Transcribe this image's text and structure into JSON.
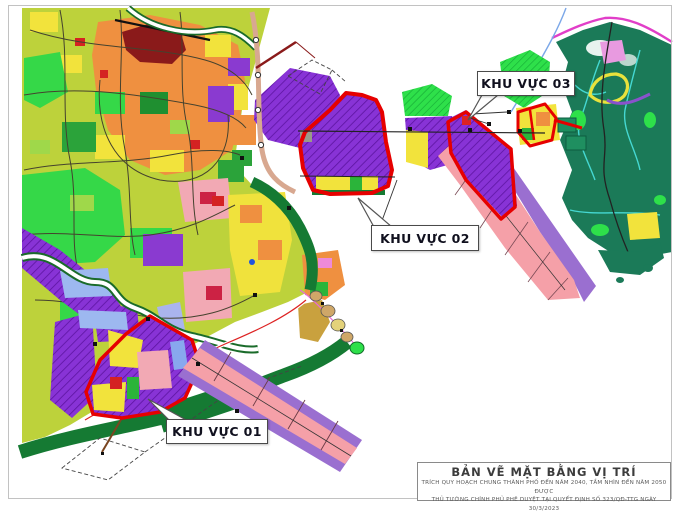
{
  "map": {
    "name": "urban-master-plan-location-map",
    "areas": [
      {
        "id": "01",
        "label": "KHU VỰC 01"
      },
      {
        "id": "02",
        "label": "KHU VỰC 02"
      },
      {
        "id": "03",
        "label": "KHU VỰC 03"
      }
    ],
    "title_block": {
      "title": "BẢN VẼ MẶT BẰNG VỊ TRÍ",
      "line1": "TRÍCH QUY HOẠCH CHUNG THÀNH PHỐ ĐẾN NĂM 2040, TẦM NHÌN ĐẾN NĂM 2050 ĐƯỢC",
      "line2": "THỦ TƯỚNG CHÍNH PHỦ PHÊ DUYỆT TẠI QUYẾT ĐỊNH SỐ 323/QĐ-TTG NGÀY 30/3/2023"
    },
    "colors": {
      "area_outline_red": "#e60000",
      "planned_zone_purple": "#8833d6",
      "corridor_pink": "#f5a0a8",
      "corridor_edge_purple": "#9a6fd0",
      "urban_base_yellow_green": "#bdd23b",
      "urban_orange": "#ef9040",
      "historic_dark_red": "#8a1a1a",
      "park_bright_green": "#35d848",
      "forest_dark_teal": "#1b7a58",
      "coast_band_green": "#157a33",
      "boundary_magenta": "#e13ec8",
      "stream_cyan": "#45d8d2",
      "residential_pink": "#f2a9b4",
      "yellow_zone": "#f2e33c"
    }
  }
}
